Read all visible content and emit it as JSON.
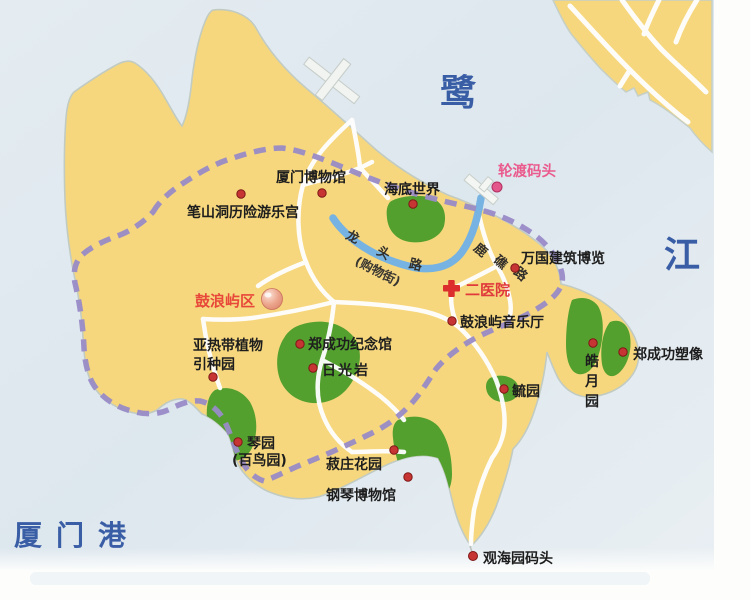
{
  "map": {
    "region_name": "Gulangyu island tourist map",
    "sea_labels": [
      {
        "id": "lu",
        "text": "鹭"
      },
      {
        "id": "jiang",
        "text": "江"
      },
      {
        "id": "xiamen-harbor",
        "text": "厦门港"
      }
    ],
    "streets": [
      {
        "name": "龙头路",
        "chars": [
          "龙",
          "头",
          "路"
        ],
        "note": "(购物街)"
      },
      {
        "name": "鹿礁路",
        "chars": [
          "鹿",
          "礁",
          "路"
        ]
      }
    ],
    "pois": [
      {
        "id": "bishandong-palace",
        "label": "笔山洞历险游乐宫"
      },
      {
        "id": "xiamen-museum",
        "label": "厦门博物馆"
      },
      {
        "id": "underwater-world",
        "label": "海底世界"
      },
      {
        "id": "ferry-terminal",
        "label": "轮渡码头"
      },
      {
        "id": "wanguo-architecture",
        "label": "万国建筑博览"
      },
      {
        "id": "second-hospital",
        "label": "二医院"
      },
      {
        "id": "gulangyu-district",
        "label": "鼓浪屿区"
      },
      {
        "id": "concert-hall",
        "label": "鼓浪屿音乐厅"
      },
      {
        "id": "subtropical-garden",
        "label": "亚热带植物",
        "label2": "引种园"
      },
      {
        "id": "zheng-memorial",
        "label": "郑成功纪念馆"
      },
      {
        "id": "sunlight-rock",
        "label": "日光岩"
      },
      {
        "id": "yuyuan-garden",
        "label": "毓园"
      },
      {
        "id": "haoyue-garden",
        "label": "皓月园",
        "chars": [
          "皓",
          "月",
          "园"
        ]
      },
      {
        "id": "zheng-statue",
        "label": "郑成功塑像"
      },
      {
        "id": "qinyuan-garden",
        "label": "琴园",
        "label2": "(百鸟园)"
      },
      {
        "id": "shuzhuang-garden",
        "label": "菽庄花园"
      },
      {
        "id": "piano-museum",
        "label": "钢琴博物馆"
      },
      {
        "id": "guanhaiyuan-wharf",
        "label": "观海园码头"
      }
    ],
    "colors": {
      "sea": "#dfe8ee",
      "land": "#f6d77e",
      "park_green": "#54a02f",
      "route_purple": "#998bc7",
      "road_blue": "#76b3e3",
      "road_white": "#ffffff",
      "marker_red": "#c63534",
      "ferry_pink": "#e4578a",
      "hospital_red": "#dc2e2c",
      "district_red": "#e8483a",
      "sea_text_blue": "#3a5ea6"
    }
  }
}
